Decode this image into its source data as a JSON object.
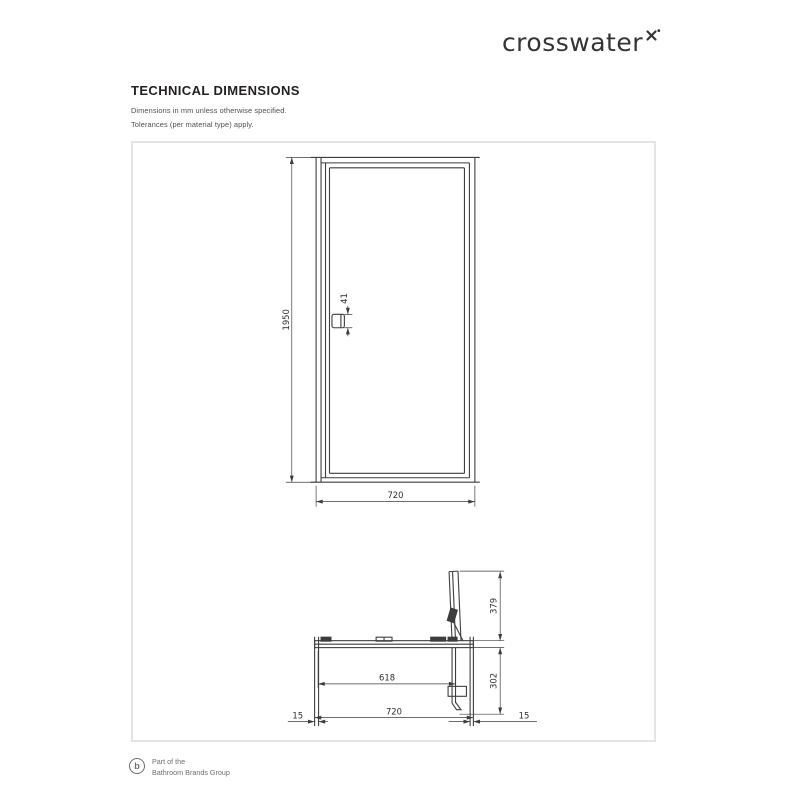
{
  "brand": {
    "name": "crosswater"
  },
  "header": {
    "title": "TECHNICAL DIMENSIONS",
    "note1": "Dimensions in mm unless otherwise specified.",
    "note2": "Tolerances (per material type) apply."
  },
  "drawing": {
    "front_view": {
      "height_mm": "1950",
      "width_mm": "720",
      "handle_mm": "41"
    },
    "plan_view": {
      "outward_projection_mm": "379",
      "inward_projection_mm": "302",
      "clear_opening_mm": "618",
      "overall_width_mm": "720",
      "left_adjustment_mm": "15",
      "right_adjustment_mm": "15"
    }
  },
  "footer": {
    "line1": "Part of the",
    "line2": "Bathroom Brands Group"
  },
  "colors": {
    "drawing_line": "#3d3d3d",
    "box_border": "#e4e4e4",
    "muted_text": "#6e6e6e"
  }
}
